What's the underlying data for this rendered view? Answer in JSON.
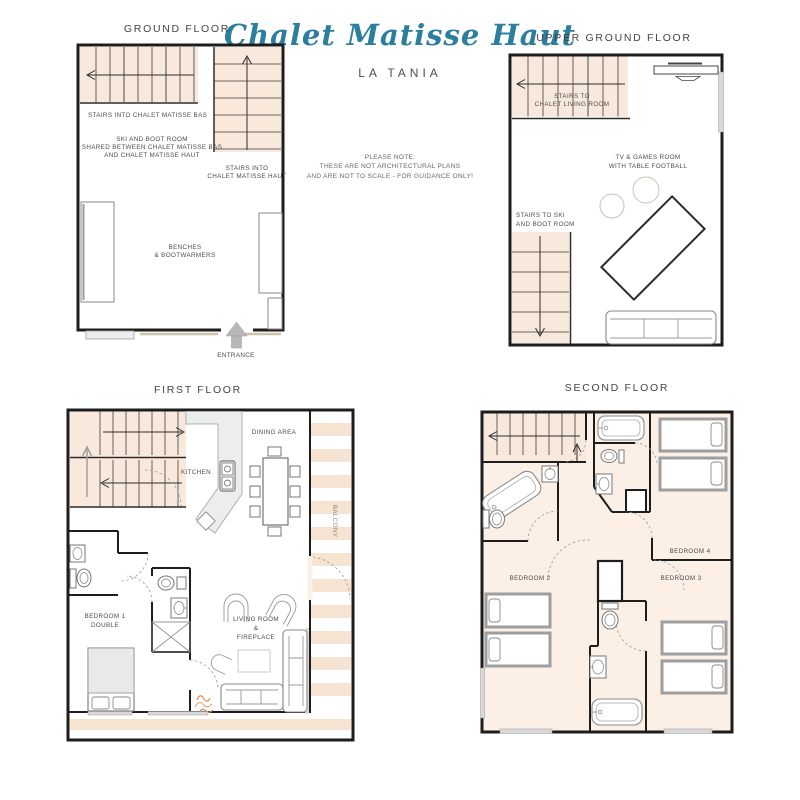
{
  "header": {
    "title": "Chalet Matisse Haut",
    "subtitle": "LA TANIA"
  },
  "note": [
    "PLEASE NOTE:",
    "THESE ARE NOT ARCHITECTURAL PLANS",
    "AND ARE NOT TO SCALE - FOR GUIDANCE ONLY!"
  ],
  "floors": {
    "ground": {
      "title": "GROUND FLOOR",
      "stairs_bas": "STAIRS INTO CHALET MATISSE BAS",
      "ski_room": [
        "SKI AND BOOT ROOM",
        "SHARED BETWEEN CHALET MATISSE BAS",
        "AND CHALET MATISSE HAUT"
      ],
      "stairs_haut": [
        "STAIRS INTO",
        "CHALET MATISSE HAUT"
      ],
      "benches": [
        "BENCHES",
        "& BOOTWARMERS"
      ],
      "entrance": "ENTRANCE"
    },
    "upper_ground": {
      "title": "UPPER GROUND FLOOR",
      "stairs_living": [
        "STAIRS TO",
        "CHALET LIVING ROOM"
      ],
      "tv_games": [
        "TV & GAMES ROOM",
        "WITH TABLE FOOTBALL"
      ],
      "stairs_ski": [
        "STAIRS TO SKI",
        "AND BOOT ROOM"
      ]
    },
    "first": {
      "title": "FIRST FLOOR",
      "kitchen": "KITCHEN",
      "dining": "DINING AREA",
      "balcony": "BALCONY",
      "bedroom1": [
        "BEDROOM 1",
        "DOUBLE"
      ],
      "living": [
        "LIVING ROOM",
        "&",
        "FIREPLACE"
      ]
    },
    "second": {
      "title": "SECOND FLOOR",
      "bedroom2": "BEDROOM 2",
      "bedroom3": "BEDROOM 3",
      "bedroom4": "BEDROOM 4"
    }
  },
  "colors": {
    "accent": "#2b7e9e",
    "floor_fill": "#fcefe6",
    "stair_fill": "#f9e9dc",
    "stripe": "#f6e3d2",
    "wall": "#1d1d1d"
  }
}
